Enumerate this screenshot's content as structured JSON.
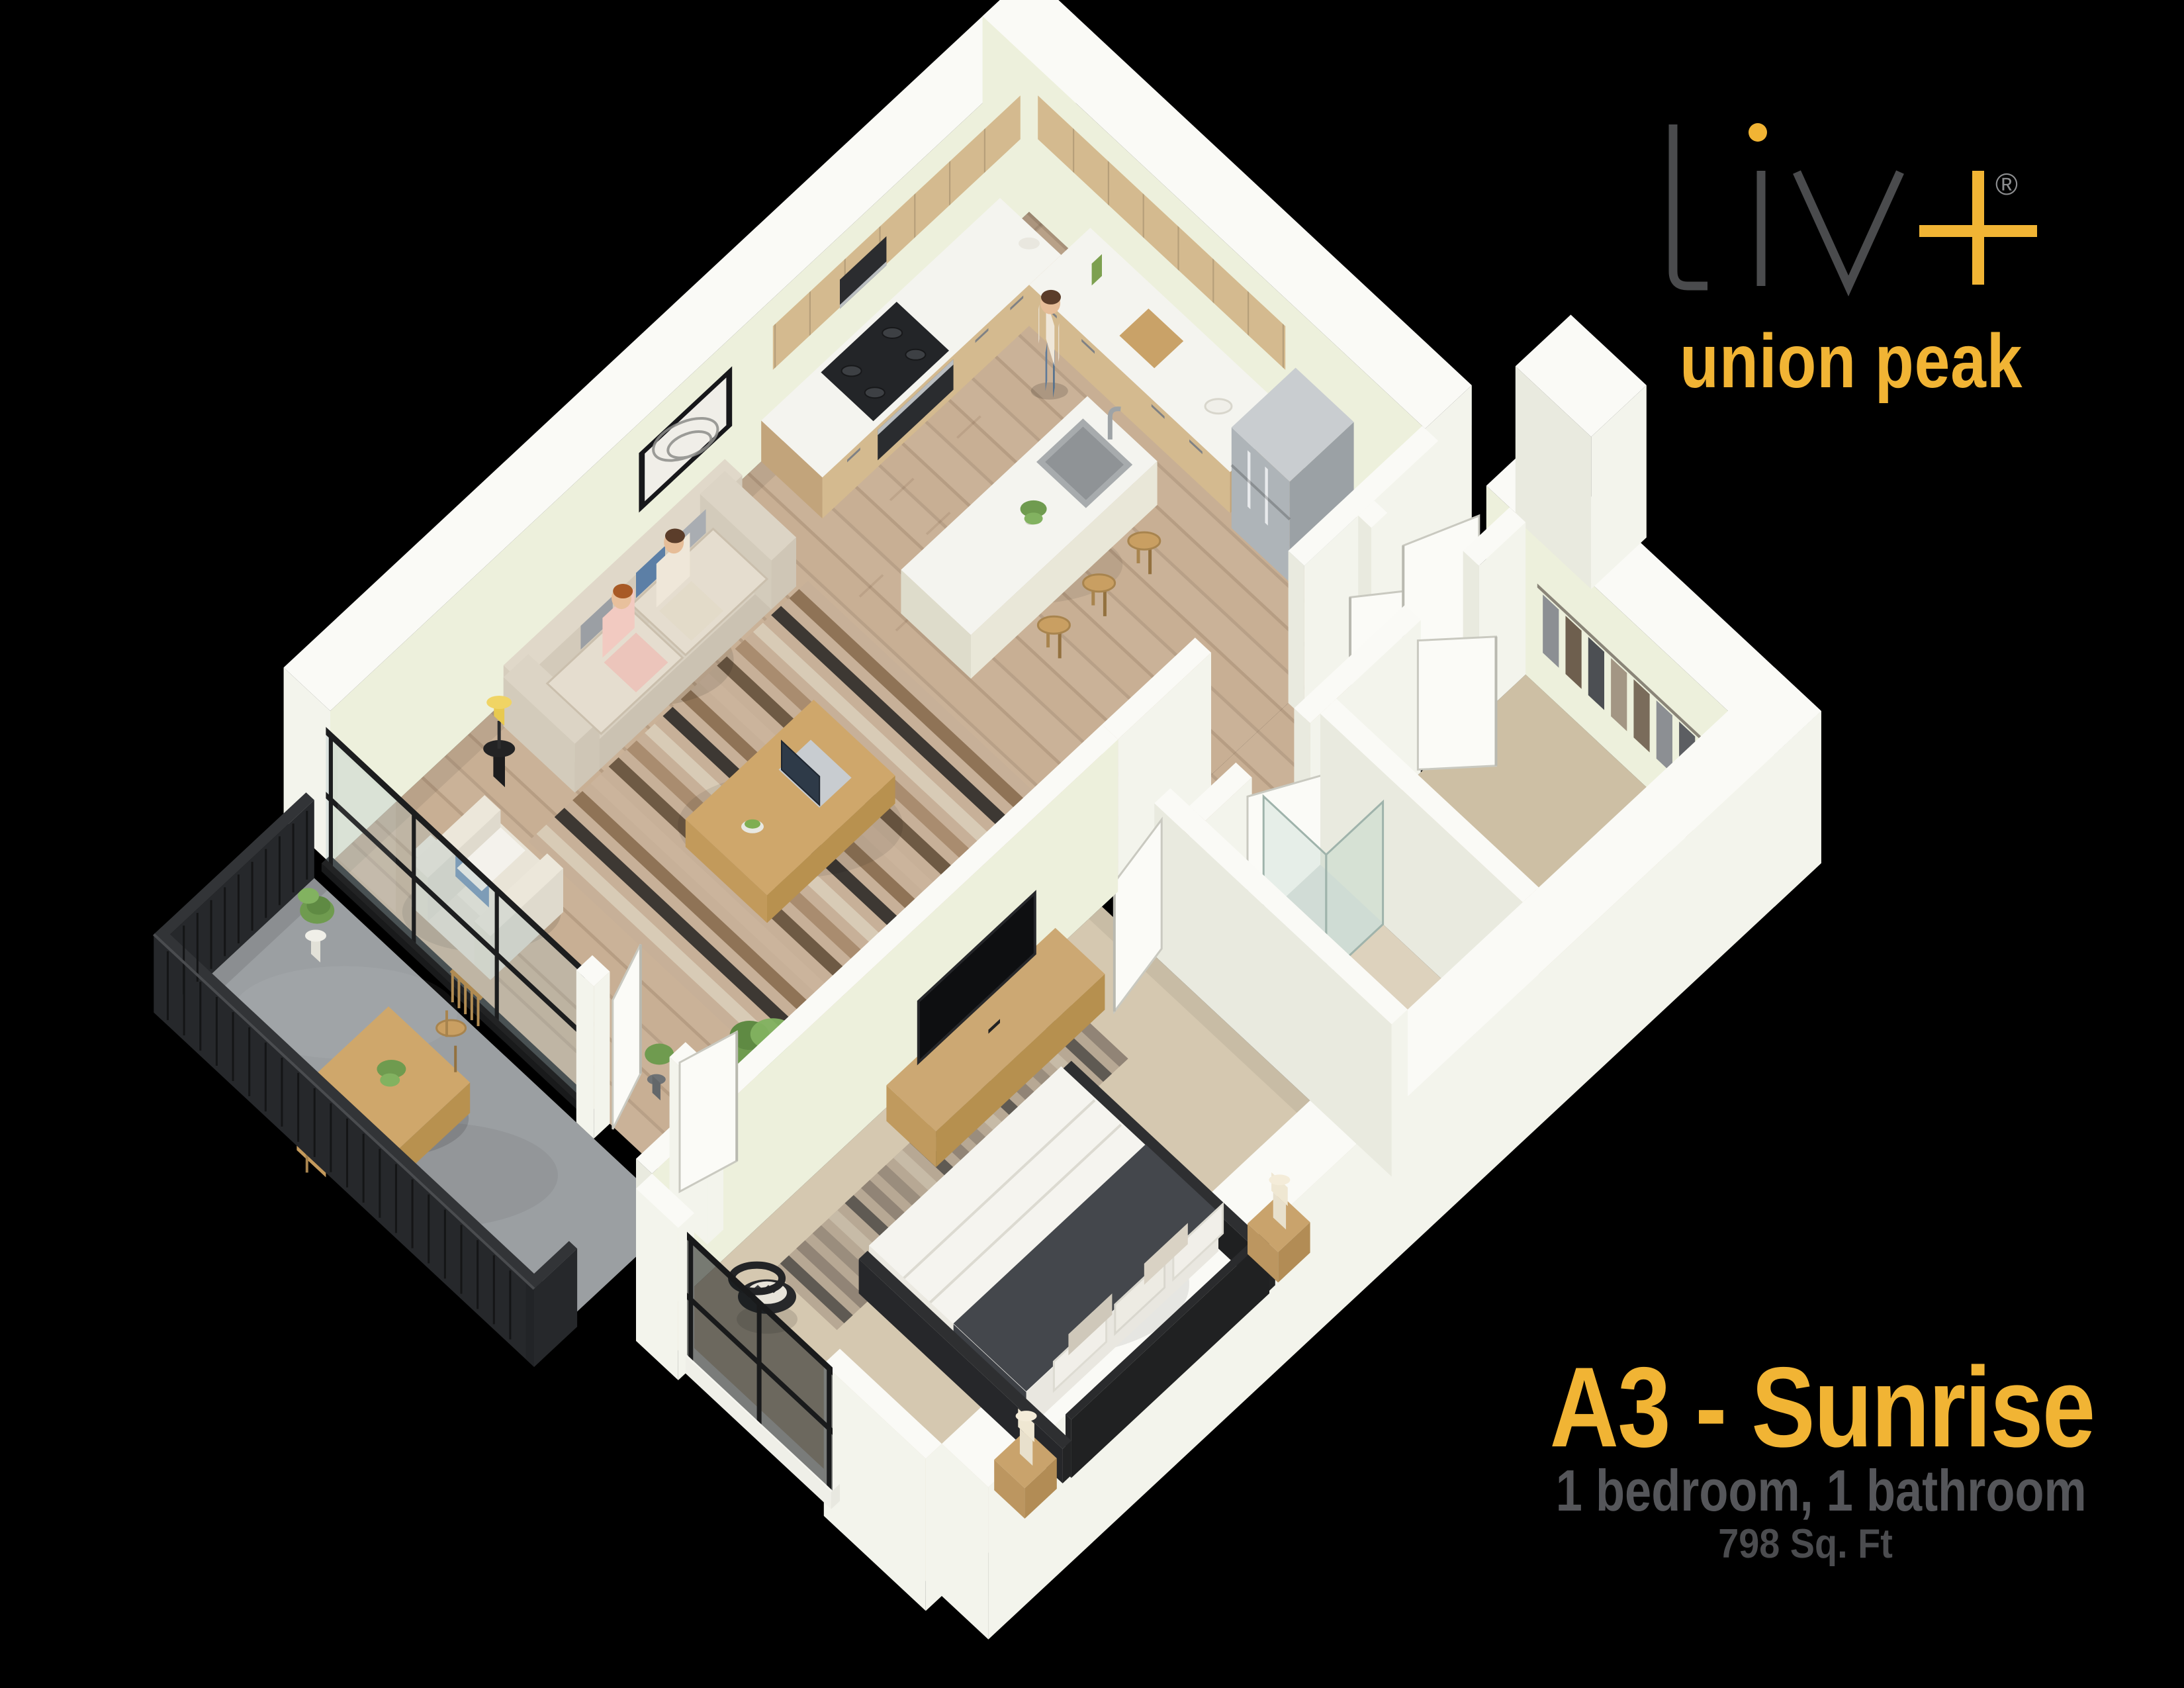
{
  "brand": {
    "name": "liv+",
    "registered": "®",
    "tagline": "union peak"
  },
  "plan": {
    "title": "A3 - Sunrise",
    "details": "1 bedroom, 1 bathroom",
    "area": "798 Sq. Ft"
  },
  "palette": {
    "background": "#000000",
    "accent": "#F1B434",
    "logoGray": "#4A4B4D",
    "detailGray": "#55565A",
    "areaGray": "#4B4C4F",
    "regGray": "#8D8E90",
    "wallTop": "#FAFAF6",
    "wallLight": "#F3F4EC",
    "wallCream": "#E9EADF",
    "wallGreen": "#EDF0DC",
    "floorWood": "#C8AF94",
    "floorCloset": "#CDBFA4",
    "floorBath": "#DDD2BD",
    "floorBedroom": "#D5C8B0",
    "floorBalcony": "#9B9FA2",
    "railing": "#26282B",
    "cabinet": "#D4BA8F",
    "cabinetDark": "#C2A47B",
    "counter": "#F4F4EF",
    "stainless": "#AEB4B8",
    "glass": "rgba(165,188,192,0.30)",
    "plantGreen": "#6F9B4F",
    "oak": "#CFA76B",
    "sofaBeige": "#D8D0C1",
    "bedWhite": "#F5F4EF",
    "bedBlanket": "#44474C",
    "bedFrame": "#2E2F31"
  }
}
